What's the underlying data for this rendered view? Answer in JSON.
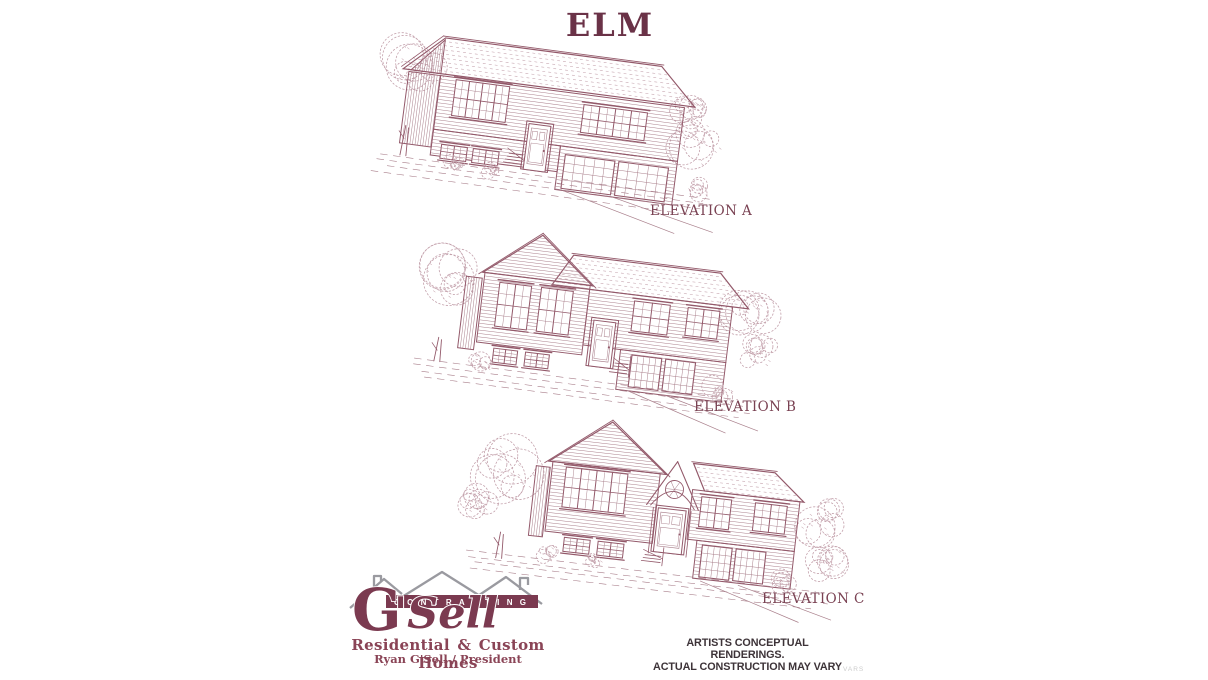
{
  "title": "ELM",
  "elevations": [
    {
      "label": "ELEVATION A"
    },
    {
      "label": "ELEVATION B"
    },
    {
      "label": "ELEVATION C"
    }
  ],
  "logo": {
    "g_letter": "G",
    "sell_text": "'Sell",
    "banner": "CONTRACTING",
    "tagline": "Residential & Custom Homes",
    "byline": "Ryan G'Sell / President"
  },
  "disclaimer": {
    "line1": "ARTISTS CONCEPTUAL RENDERINGS.",
    "line2": "ACTUAL CONSTRUCTION MAY VARY"
  },
  "watermark": "VARS",
  "colors": {
    "background": "#ffffff",
    "ink": "#93596a",
    "ink_mid": "#a97f8b",
    "ink_light": "#c3a0ab",
    "title": "#6a3247",
    "label": "#7a4253",
    "logo_maroon": "#7b3a50",
    "logo_gray": "#9a9aa0",
    "disclaimer": "#3d3338",
    "watermark": "#cccccc"
  }
}
